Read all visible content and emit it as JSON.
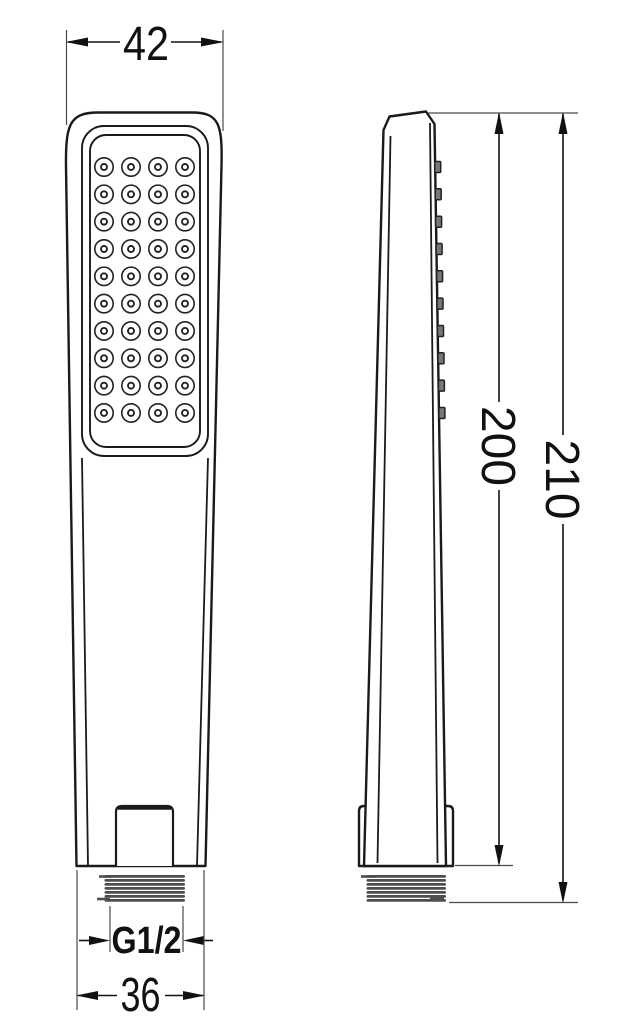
{
  "dimensions": {
    "head_width": "42",
    "handle_length": "200",
    "total_length": "210",
    "thread": "G1/2",
    "base_width": "36"
  },
  "nozzles": {
    "rows": 10,
    "cols": 4
  },
  "side_nub_count": 10,
  "thread_band_count": 7,
  "colors": {
    "line": "#1a1a1a",
    "thread_band": "#4e4e4e",
    "background": "#ffffff"
  }
}
